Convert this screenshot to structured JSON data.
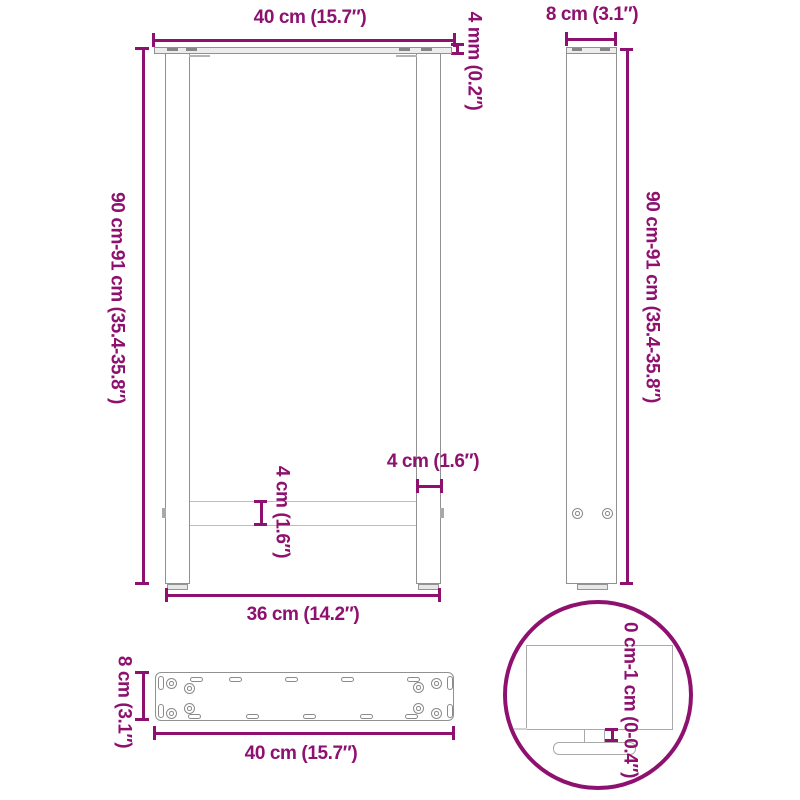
{
  "diagram": {
    "title": "table-legs-dimension-diagram",
    "colors": {
      "dimension": "#8E106F",
      "part_outline": "#919191",
      "part_fill": "#ececec",
      "background": "#ffffff"
    },
    "front_view": {
      "top_width_label": "40 cm (15.7″)",
      "plate_thickness_label": "4 mm (0.2″)",
      "height_label": "90 cm-91 cm (35.4-35.8″)",
      "crossbar_thickness_label": "4 cm (1.6″)",
      "leg_width_label": "4 cm (1.6″)",
      "bottom_width_label": "36 cm (14.2″)"
    },
    "side_view": {
      "depth_label": "8 cm (3.1″)",
      "height_label": "90 cm-91 cm (35.4-35.8″)"
    },
    "plate_view": {
      "depth_label": "8 cm (3.1″)",
      "width_label": "40 cm (15.7″)"
    },
    "detail_view": {
      "adjustment_label": "0 cm-1 cm (0-0.4″)"
    }
  }
}
